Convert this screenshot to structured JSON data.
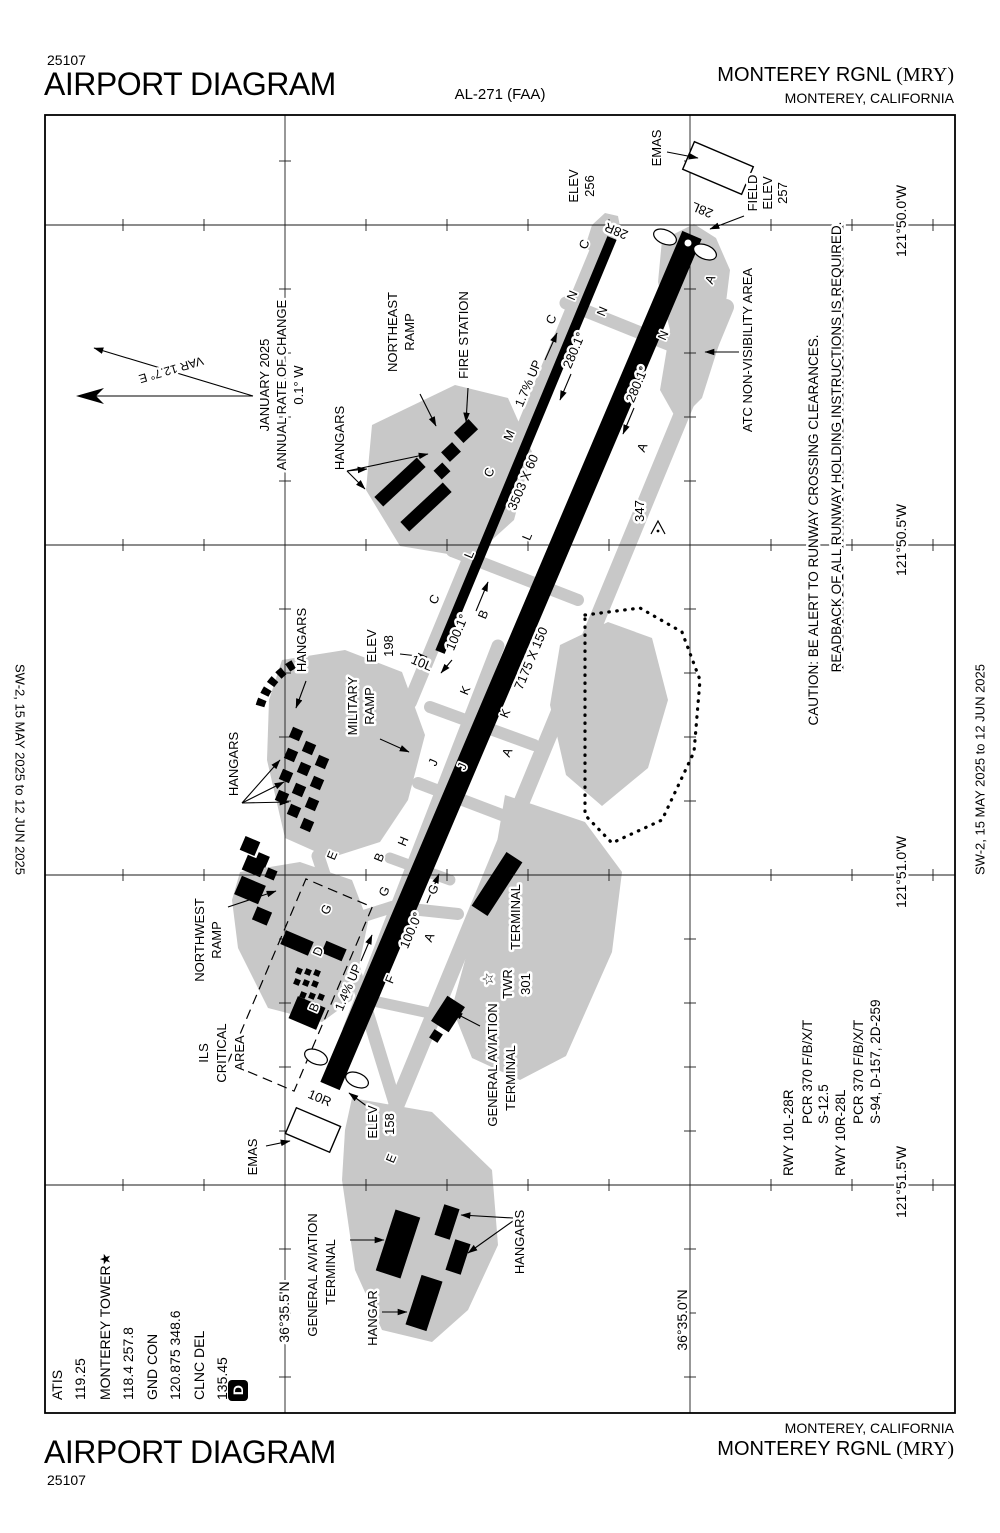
{
  "header": {
    "code": "25107",
    "title": "AIRPORT DIAGRAM",
    "al": "AL-271 (FAA)",
    "airport": "MONTEREY RGNL",
    "icao": "(MRY)",
    "city": "MONTEREY, CALIFORNIA"
  },
  "footer": {
    "code": "25107",
    "title": "AIRPORT DIAGRAM",
    "airport": "MONTEREY RGNL",
    "icao": "(MRY)",
    "city": "MONTEREY, CALIFORNIA"
  },
  "margin": {
    "left": "SW-2,  15 MAY 2025  to  12 JUN 2025",
    "right": "SW-2,  15 MAY 2025  to  12 JUN 2025"
  },
  "chart": {
    "colors": {
      "apron": "#c8c8c8",
      "ink": "#000000"
    },
    "frequencies": {
      "lines": [
        {
          "t": "ATIS",
          "x": 62
        },
        {
          "t": "119.25",
          "x": 85
        },
        {
          "t": "MONTEREY TOWER★",
          "x": 110
        },
        {
          "t": "118.4 257.8",
          "x": 133
        },
        {
          "t": "GND CON",
          "x": 157
        },
        {
          "t": "120.875 348.6",
          "x": 180
        },
        {
          "t": "CLNC DEL",
          "x": 204
        },
        {
          "t": "135.45",
          "x": 227
        }
      ],
      "datis": "D"
    },
    "runway_data": {
      "lines": [
        {
          "t": "RWY 10L-28R",
          "x": 793,
          "b": 1176
        },
        {
          "t": "PCR 370 F/B/X/T",
          "x": 812,
          "b": 1124
        },
        {
          "t": "S-12.5",
          "x": 828,
          "b": 1124
        },
        {
          "t": "RWY 10R-28L",
          "x": 845,
          "b": 1176
        },
        {
          "t": "PCR 370 F/B/X/T",
          "x": 863,
          "b": 1124
        },
        {
          "t": "S-94, D-157, 2D-259",
          "x": 880,
          "b": 1124
        }
      ]
    },
    "labels": [
      {
        "t": "EMAS",
        "x": 661,
        "y": 148
      },
      {
        "t": "28L",
        "x": 704,
        "y": 206,
        "r": -157
      },
      {
        "t": "FIELD",
        "x": 757,
        "y": 193
      },
      {
        "t": "ELEV",
        "x": 772,
        "y": 193
      },
      {
        "t": "257",
        "x": 787,
        "y": 193
      },
      {
        "t": "ELEV",
        "x": 578,
        "y": 186
      },
      {
        "t": "256",
        "x": 594,
        "y": 186
      },
      {
        "t": "28R",
        "x": 618,
        "y": 227,
        "r": -157
      },
      {
        "t": "ATC NON-VISIBILITY AREA",
        "x": 752,
        "y": 350
      },
      {
        "t": "NORTHEAST",
        "x": 397,
        "y": 332
      },
      {
        "t": "RAMP",
        "x": 414,
        "y": 332
      },
      {
        "t": "FIRE STATION",
        "x": 468,
        "y": 335
      },
      {
        "t": "HANGARS",
        "x": 344,
        "y": 438
      },
      {
        "t": "JANUARY 2025",
        "x": 269,
        "y": 385
      },
      {
        "t": "ANNUAL RATE OF CHANGE",
        "x": 286,
        "y": 385
      },
      {
        "t": "0.1° W",
        "x": 303,
        "y": 385
      },
      {
        "t": "VAR 12.7° E",
        "x": 170,
        "y": 366,
        "r": 163.5,
        "fs": 12
      },
      {
        "t": "1.7% UP",
        "x": 532,
        "y": 385,
        "r": -67,
        "fs": 12.5
      },
      {
        "t": "3503 X 60",
        "x": 527,
        "y": 484,
        "r": -67
      },
      {
        "t": "280.1°",
        "x": 578,
        "y": 352,
        "r": -67
      },
      {
        "t": "280.1°",
        "x": 641,
        "y": 386,
        "r": -67
      },
      {
        "t": "347",
        "x": 644,
        "y": 511
      },
      {
        "t": "ELEV",
        "x": 376,
        "y": 646
      },
      {
        "t": "198",
        "x": 393,
        "y": 646
      },
      {
        "t": "10L",
        "x": 420,
        "y": 667,
        "r": 23
      },
      {
        "t": "100.1°",
        "x": 461,
        "y": 634,
        "r": -67
      },
      {
        "t": "7175 X 150",
        "x": 535,
        "y": 660,
        "r": -67
      },
      {
        "t": "MILITARY",
        "x": 357,
        "y": 706
      },
      {
        "t": "RAMP",
        "x": 374,
        "y": 706
      },
      {
        "t": "HANGARS",
        "x": 306,
        "y": 640
      },
      {
        "t": "HANGARS",
        "x": 238,
        "y": 764
      },
      {
        "t": "NORTHWEST",
        "x": 204,
        "y": 940
      },
      {
        "t": "RAMP",
        "x": 221,
        "y": 940
      },
      {
        "t": "ILS",
        "x": 208,
        "y": 1053
      },
      {
        "t": "CRITICAL",
        "x": 226,
        "y": 1053
      },
      {
        "t": "AREA",
        "x": 244,
        "y": 1053
      },
      {
        "t": "1.4% UP",
        "x": 352,
        "y": 989,
        "r": -67,
        "fs": 12.5
      },
      {
        "t": "100.0°",
        "x": 415,
        "y": 932,
        "r": -67
      },
      {
        "t": "TERMINAL",
        "x": 520,
        "y": 917
      },
      {
        "t": "☆",
        "x": 493,
        "y": 979,
        "fs": 15
      },
      {
        "t": "TWR",
        "x": 512,
        "y": 984
      },
      {
        "t": "301",
        "x": 530,
        "y": 984
      },
      {
        "t": "GENERAL AVIATION",
        "x": 497,
        "y": 1065
      },
      {
        "t": "TERMINAL",
        "x": 515,
        "y": 1078
      },
      {
        "t": "EMAS",
        "x": 257,
        "y": 1157
      },
      {
        "t": "10R",
        "x": 318,
        "y": 1102,
        "r": 23
      },
      {
        "t": "ELEV",
        "x": 377,
        "y": 1122
      },
      {
        "t": "158",
        "x": 394,
        "y": 1124
      },
      {
        "t": "GENERAL AVIATION",
        "x": 317,
        "y": 1275
      },
      {
        "t": "TERMINAL",
        "x": 335,
        "y": 1272
      },
      {
        "t": "HANGAR",
        "x": 377,
        "y": 1318
      },
      {
        "t": "HANGARS",
        "x": 524,
        "y": 1242
      },
      {
        "t": "CAUTION: BE ALERT TO RUNWAY CROSSING CLEARANCES.",
        "x": 818,
        "y": 530,
        "fs": 13.5
      },
      {
        "t": "READBACK OF ALL RUNWAY HOLDING INSTRUCTIONS IS REQUIRED.",
        "x": 841,
        "y": 447,
        "fs": 13.5,
        "u": true
      },
      {
        "t": "121°50.0'W",
        "x": 906,
        "y": 221,
        "fs": 14
      },
      {
        "t": "121°50.5'W",
        "x": 906,
        "y": 540,
        "fs": 14
      },
      {
        "t": "121°51.0'W",
        "x": 906,
        "y": 872,
        "fs": 14
      },
      {
        "t": "121°51.5'W",
        "x": 906,
        "y": 1182,
        "fs": 14
      },
      {
        "t": "36°35.5'N",
        "x": 289,
        "y": 1312,
        "fs": 14
      },
      {
        "t": "36°35.0'N",
        "x": 687,
        "y": 1320,
        "fs": 14
      }
    ],
    "taxiway_letters": [
      {
        "t": "A",
        "x": 714,
        "y": 281
      },
      {
        "t": "A",
        "x": 646,
        "y": 449
      },
      {
        "t": "A",
        "x": 511,
        "y": 754
      },
      {
        "t": "A",
        "x": 433,
        "y": 939
      },
      {
        "t": "B",
        "x": 487,
        "y": 616
      },
      {
        "t": "B",
        "x": 383,
        "y": 859
      },
      {
        "t": "B",
        "x": 318,
        "y": 1009
      },
      {
        "t": "C",
        "x": 588,
        "y": 246
      },
      {
        "t": "C",
        "x": 555,
        "y": 321
      },
      {
        "t": "C",
        "x": 493,
        "y": 474
      },
      {
        "t": "C",
        "x": 438,
        "y": 601
      },
      {
        "t": "D",
        "x": 322,
        "y": 953
      },
      {
        "t": "E",
        "x": 336,
        "y": 857
      },
      {
        "t": "E",
        "x": 395,
        "y": 1160
      },
      {
        "t": "F",
        "x": 394,
        "y": 981
      },
      {
        "t": "G",
        "x": 330,
        "y": 911
      },
      {
        "t": "G",
        "x": 388,
        "y": 893
      },
      {
        "t": "G",
        "x": 437,
        "y": 891
      },
      {
        "t": "H",
        "x": 407,
        "y": 843
      },
      {
        "t": "J",
        "x": 437,
        "y": 764
      },
      {
        "t": "J",
        "x": 466,
        "y": 768
      },
      {
        "t": "K",
        "x": 469,
        "y": 692
      },
      {
        "t": "K",
        "x": 509,
        "y": 715
      },
      {
        "t": "L",
        "x": 531,
        "y": 538
      },
      {
        "t": "L",
        "x": 473,
        "y": 556
      },
      {
        "t": "M",
        "x": 513,
        "y": 437
      },
      {
        "t": "N",
        "x": 576,
        "y": 297
      },
      {
        "t": "N",
        "x": 606,
        "y": 313
      },
      {
        "t": "N",
        "x": 667,
        "y": 337
      }
    ]
  }
}
